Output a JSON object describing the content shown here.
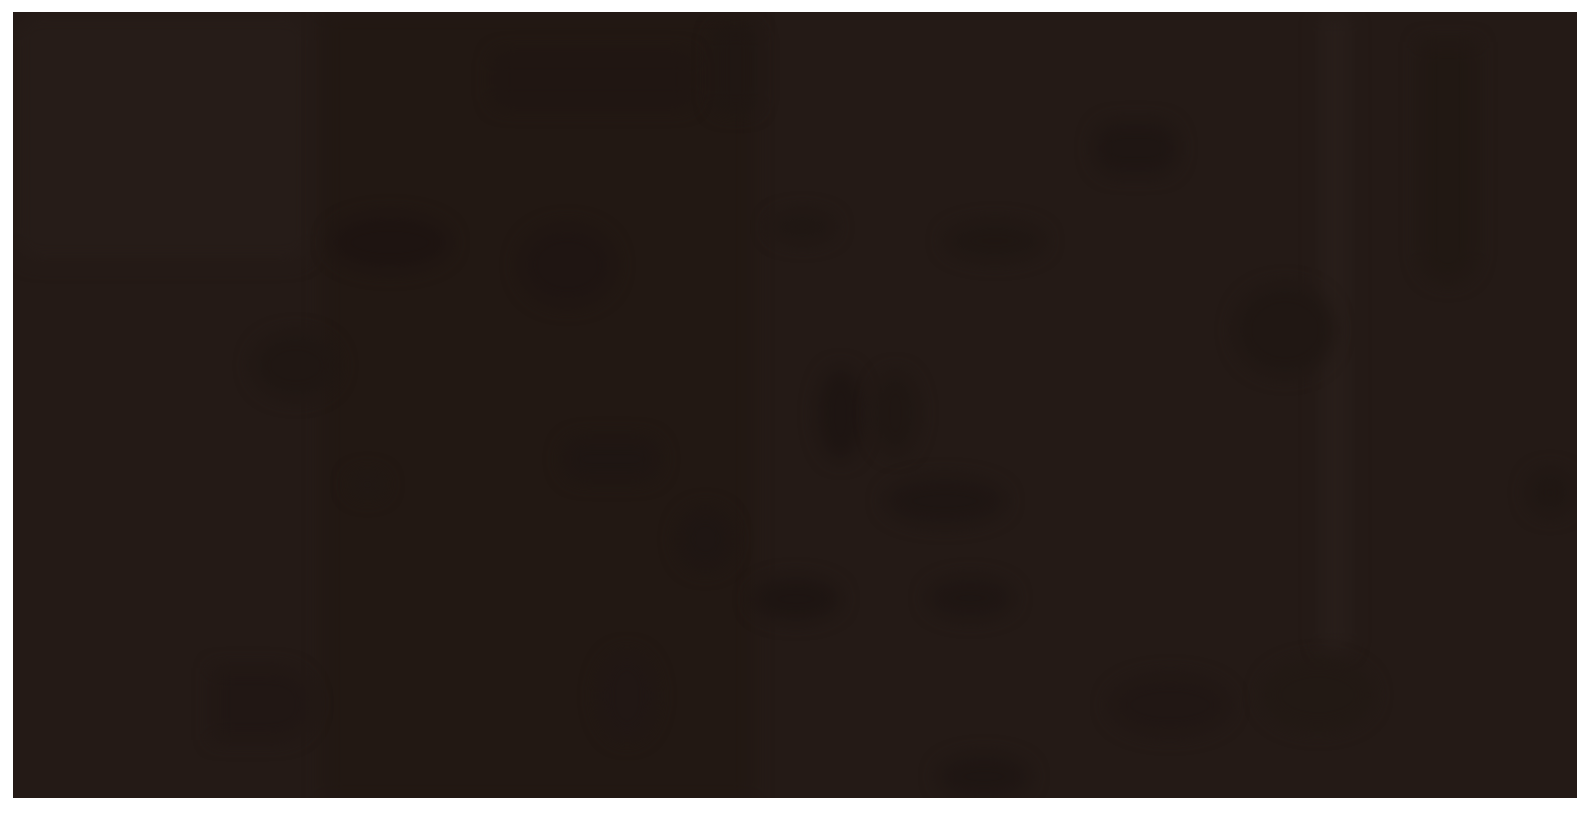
{
  "page": {
    "background_color": "#ffffff"
  },
  "photo": {
    "kind": "underexposed-dark-photograph",
    "base_color": "#241a16",
    "frame": {
      "left": 13,
      "top": 12,
      "width": 1564,
      "height": 786
    },
    "faint_shade_colors": {
      "darkest": "#1e1411",
      "dark": "#1f1613",
      "mid_dark": "#201713",
      "slightly_dark": "#211814",
      "slightly_light": "#271d19",
      "light_band": "#281e1a"
    },
    "blobs": [
      {
        "x": 0,
        "y": 0,
        "w": 300,
        "h": 250,
        "color": "#261c18",
        "r": "24px"
      },
      {
        "x": 310,
        "y": 0,
        "w": 430,
        "h": 790,
        "color": "#221813",
        "r": "0px"
      },
      {
        "x": 1307,
        "y": 0,
        "w": 30,
        "h": 640,
        "color": "#281e1a",
        "r": "10px"
      },
      {
        "x": 1407,
        "y": 30,
        "w": 56,
        "h": 240,
        "color": "#211813",
        "r": "0 0 28px 28px"
      },
      {
        "x": 1082,
        "y": 110,
        "w": 82,
        "h": 52,
        "color": "#1f1613",
        "r": "22px"
      },
      {
        "x": 317,
        "y": 203,
        "w": 120,
        "h": 55,
        "color": "#1e1411",
        "r": "50%"
      },
      {
        "x": 507,
        "y": 213,
        "w": 95,
        "h": 80,
        "color": "#1f1512",
        "r": "50%"
      },
      {
        "x": 757,
        "y": 200,
        "w": 65,
        "h": 30,
        "color": "#201713",
        "r": "50%"
      },
      {
        "x": 932,
        "y": 210,
        "w": 100,
        "h": 38,
        "color": "#201713",
        "r": "50%"
      },
      {
        "x": 1222,
        "y": 273,
        "w": 100,
        "h": 90,
        "color": "#201713",
        "r": "50%"
      },
      {
        "x": 240,
        "y": 321,
        "w": 85,
        "h": 65,
        "color": "#201713",
        "r": "50%"
      },
      {
        "x": 805,
        "y": 356,
        "w": 45,
        "h": 92,
        "color": "#1e1512",
        "r": "50%"
      },
      {
        "x": 860,
        "y": 360,
        "w": 45,
        "h": 82,
        "color": "#201713",
        "r": "50%"
      },
      {
        "x": 550,
        "y": 426,
        "w": 97,
        "h": 42,
        "color": "#1f1613",
        "r": "20px"
      },
      {
        "x": 337,
        "y": 460,
        "w": 35,
        "h": 25,
        "color": "#211814",
        "r": "50%"
      },
      {
        "x": 872,
        "y": 466,
        "w": 120,
        "h": 46,
        "color": "#1f1613",
        "r": "50%"
      },
      {
        "x": 1515,
        "y": 458,
        "w": 45,
        "h": 45,
        "color": "#201713",
        "r": "50%"
      },
      {
        "x": 665,
        "y": 496,
        "w": 55,
        "h": 62,
        "color": "#1f1613",
        "r": "50%"
      },
      {
        "x": 739,
        "y": 566,
        "w": 88,
        "h": 42,
        "color": "#1e1512",
        "r": "50%"
      },
      {
        "x": 915,
        "y": 566,
        "w": 85,
        "h": 40,
        "color": "#1f1613",
        "r": "50%"
      },
      {
        "x": 200,
        "y": 656,
        "w": 100,
        "h": 72,
        "color": "#211714",
        "r": "0 36px 36px 0"
      },
      {
        "x": 585,
        "y": 640,
        "w": 58,
        "h": 88,
        "color": "#211714",
        "r": "50%"
      },
      {
        "x": 1097,
        "y": 663,
        "w": 120,
        "h": 60,
        "color": "#211714",
        "r": "50%"
      },
      {
        "x": 925,
        "y": 743,
        "w": 92,
        "h": 43,
        "color": "#1f1613",
        "r": "50%"
      },
      {
        "x": 1250,
        "y": 648,
        "w": 110,
        "h": 70,
        "color": "#221914",
        "r": "50%"
      },
      {
        "x": 480,
        "y": 40,
        "w": 200,
        "h": 55,
        "color": "#201612",
        "r": "12px"
      },
      {
        "x": 700,
        "y": 15,
        "w": 45,
        "h": 85,
        "color": "#201713",
        "r": "12px"
      }
    ]
  }
}
